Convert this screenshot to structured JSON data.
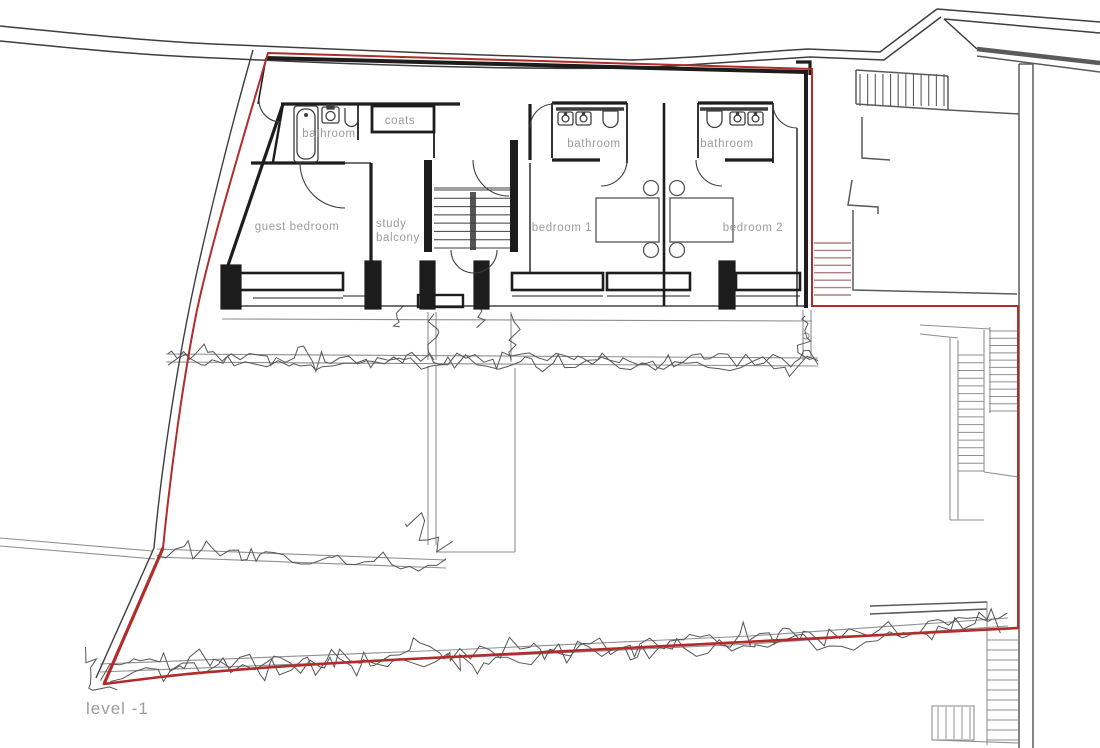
{
  "plan": {
    "level_label": "level -1",
    "rooms": {
      "bathroom_west": "bathroom",
      "coats": "coats",
      "guest_bedroom": "guest bedroom",
      "study": "study",
      "balcony": "balcony",
      "bedroom1": "bedroom 1",
      "bathroom1": "bathroom",
      "bedroom2": "bedroom 2",
      "bathroom2": "bathroom"
    },
    "colors": {
      "boundary": "#b22c2c",
      "wall": "#1d1d1d",
      "thin": "#3e3e3e",
      "terrace": "#8f8f8f",
      "vegetation": "#565656",
      "label": "#9c9c9c",
      "stair_tint": "#ad8181",
      "neighbor": "#5a5a5a"
    }
  }
}
